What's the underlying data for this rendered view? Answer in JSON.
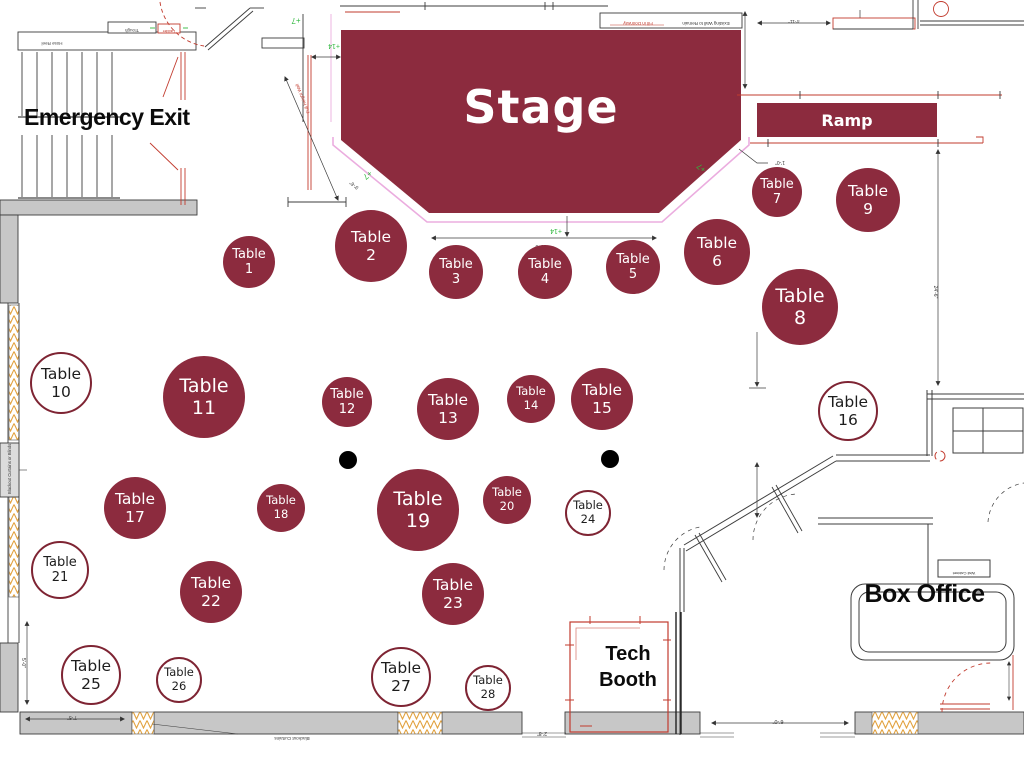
{
  "labels": {
    "stage": "Stage",
    "ramp": "Ramp",
    "emergency_exit": "Emergency Exit",
    "box_office": "Box Office",
    "tech_booth_line1": "Tech",
    "tech_booth_line2": "Booth"
  },
  "table_word": "Table",
  "tables": [
    {
      "number": 1,
      "x": 249,
      "y": 262,
      "r": 26,
      "style": "filled"
    },
    {
      "number": 2,
      "x": 371,
      "y": 246,
      "r": 36,
      "style": "filled"
    },
    {
      "number": 3,
      "x": 456,
      "y": 272,
      "r": 27,
      "style": "filled"
    },
    {
      "number": 4,
      "x": 545,
      "y": 272,
      "r": 27,
      "style": "filled"
    },
    {
      "number": 5,
      "x": 633,
      "y": 267,
      "r": 27,
      "style": "filled"
    },
    {
      "number": 6,
      "x": 717,
      "y": 252,
      "r": 33,
      "style": "filled"
    },
    {
      "number": 7,
      "x": 777,
      "y": 192,
      "r": 25,
      "style": "filled"
    },
    {
      "number": 8,
      "x": 800,
      "y": 307,
      "r": 38,
      "style": "filled"
    },
    {
      "number": 9,
      "x": 868,
      "y": 200,
      "r": 32,
      "style": "filled"
    },
    {
      "number": 10,
      "x": 61,
      "y": 383,
      "r": 31,
      "style": "outline"
    },
    {
      "number": 11,
      "x": 204,
      "y": 397,
      "r": 41,
      "style": "filled"
    },
    {
      "number": 12,
      "x": 347,
      "y": 402,
      "r": 25,
      "style": "filled"
    },
    {
      "number": 13,
      "x": 448,
      "y": 409,
      "r": 31,
      "style": "filled"
    },
    {
      "number": 14,
      "x": 531,
      "y": 399,
      "r": 24,
      "style": "filled"
    },
    {
      "number": 15,
      "x": 602,
      "y": 399,
      "r": 31,
      "style": "filled"
    },
    {
      "number": 16,
      "x": 848,
      "y": 411,
      "r": 30,
      "style": "outline"
    },
    {
      "number": 17,
      "x": 135,
      "y": 508,
      "r": 31,
      "style": "filled"
    },
    {
      "number": 18,
      "x": 281,
      "y": 508,
      "r": 24,
      "style": "filled"
    },
    {
      "number": 19,
      "x": 418,
      "y": 510,
      "r": 41,
      "style": "filled"
    },
    {
      "number": 20,
      "x": 507,
      "y": 500,
      "r": 24,
      "style": "filled"
    },
    {
      "number": 21,
      "x": 60,
      "y": 570,
      "r": 29,
      "style": "outline"
    },
    {
      "number": 22,
      "x": 211,
      "y": 592,
      "r": 31,
      "style": "filled"
    },
    {
      "number": 23,
      "x": 453,
      "y": 594,
      "r": 31,
      "style": "filled"
    },
    {
      "number": 24,
      "x": 588,
      "y": 513,
      "r": 23,
      "style": "outline"
    },
    {
      "number": 25,
      "x": 91,
      "y": 675,
      "r": 30,
      "style": "outline"
    },
    {
      "number": 26,
      "x": 179,
      "y": 680,
      "r": 23,
      "style": "outline"
    },
    {
      "number": 27,
      "x": 401,
      "y": 677,
      "r": 30,
      "style": "outline"
    },
    {
      "number": 28,
      "x": 488,
      "y": 688,
      "r": 23,
      "style": "outline"
    }
  ],
  "columns": [
    {
      "x": 348,
      "y": 460,
      "r": 9
    },
    {
      "x": 610,
      "y": 459,
      "r": 9
    }
  ],
  "annotations": {
    "green": {
      "plus7": "+7",
      "plus14": "+14"
    },
    "dims": {
      "d1_0": "1'-0\"",
      "d2_8": "2'-8\"",
      "d4_11": "4'-11\"",
      "d5_0": "5'-0\"",
      "d6_0": "6'-0\"",
      "d7_5": "7'-5\"",
      "d9_6": "9'-6\"",
      "d15_0": "15'-0\"",
      "d24_6": "24'-6\""
    },
    "arch": {
      "hose_reel": "Hose Reel",
      "trough": "Trough",
      "ladder": "Ladder",
      "fill_in_doorway": "Fill in Doorway",
      "existing_wall": "Existing Wall to Remain",
      "full_height_wall": "Full Height Wall",
      "wall_cabinet": "Wall Cabinet",
      "blackout_side": "Blackout Curtains or Blinds",
      "blackout_bottom": "Blackout Curtains"
    }
  },
  "colors": {
    "maroon": "#8C2B3E",
    "ring": "#7E2433",
    "wall_gray": "#C7C7C7",
    "line_dark": "#3C3C3C",
    "arch_red": "#C23B2E",
    "platform_pink": "#EBADDF",
    "note_green": "#2FB83D",
    "hatch_orange": "#E2A23F"
  }
}
